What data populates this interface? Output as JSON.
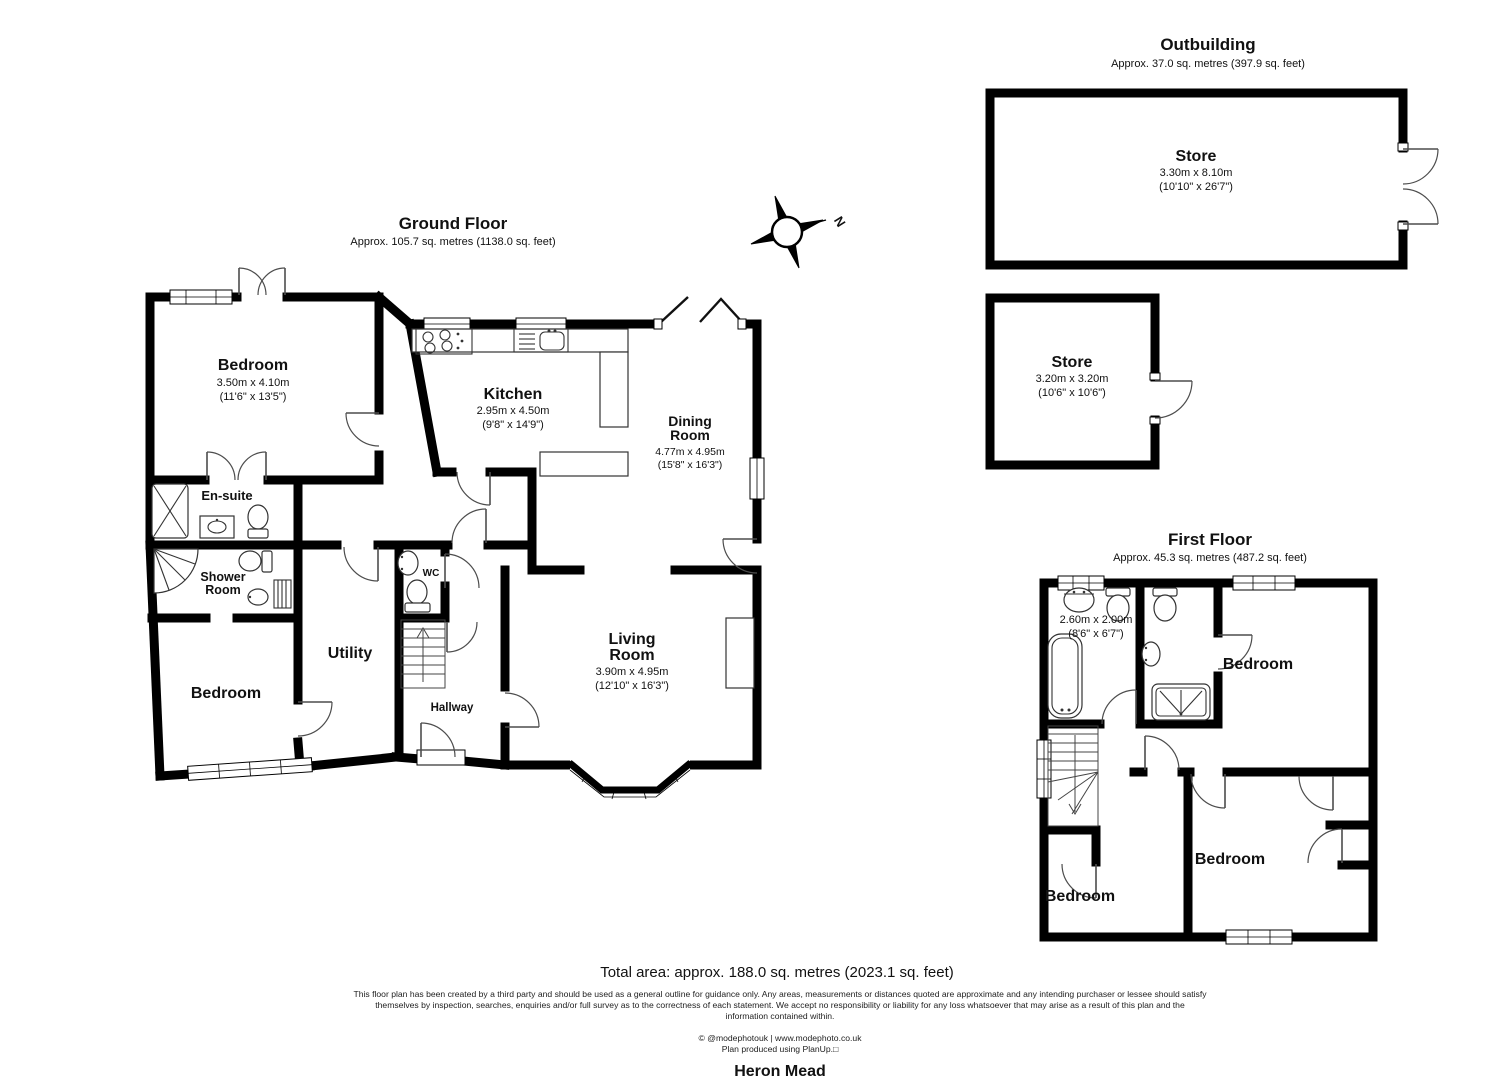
{
  "floors": {
    "ground": {
      "title": "Ground Floor",
      "area": "Approx. 105.7 sq. metres (1138.0 sq. feet)"
    },
    "first": {
      "title": "First Floor",
      "area": "Approx. 45.3 sq. metres (487.2 sq. feet)"
    },
    "outbuilding": {
      "title": "Outbuilding",
      "area": "Approx. 37.0 sq. metres (397.9 sq. feet)"
    }
  },
  "rooms": {
    "gf_bedroom1": {
      "name": "Bedroom",
      "dim_m": "3.50m x 4.10m",
      "dim_ft": "(11'6\" x 13'5\")"
    },
    "gf_kitchen": {
      "name": "Kitchen",
      "dim_m": "2.95m x 4.50m",
      "dim_ft": "(9'8\" x 14'9\")"
    },
    "gf_dining": {
      "name1": "Dining",
      "name2": "Room",
      "dim_m": "4.77m x 4.95m",
      "dim_ft": "(15'8\" x 16'3\")"
    },
    "gf_living": {
      "name1": "Living",
      "name2": "Room",
      "dim_m": "3.90m x 4.95m",
      "dim_ft": "(12'10\" x 16'3\")"
    },
    "gf_ensuite": {
      "name": "En-suite"
    },
    "gf_shower": {
      "name1": "Shower",
      "name2": "Room"
    },
    "gf_bedroom2": {
      "name": "Bedroom"
    },
    "gf_utility": {
      "name": "Utility"
    },
    "gf_wc": {
      "name": "WC"
    },
    "gf_hallway": {
      "name": "Hallway"
    },
    "ff_bath": {
      "dim_m": "2.60m x 2.00m",
      "dim_ft": "(8'6\" x 6'7\")"
    },
    "ff_bedroom1": {
      "name": "Bedroom"
    },
    "ff_bedroom2": {
      "name": "Bedroom"
    },
    "ff_bedroom3": {
      "name": "Bedroom"
    },
    "ob_store1": {
      "name": "Store",
      "dim_m": "3.30m x 8.10m",
      "dim_ft": "(10'10\" x 26'7\")"
    },
    "ob_store2": {
      "name": "Store",
      "dim_m": "3.20m x 3.20m",
      "dim_ft": "(10'6\" x 10'6\")"
    }
  },
  "compass": {
    "north_label": "N"
  },
  "footer": {
    "total_area": "Total area: approx. 188.0 sq. metres (2023.1 sq. feet)",
    "disclaimer_line1": "This floor plan has been created by a third party and should be used as a general outline for guidance only. Any areas, measurements or distances quoted are approximate and any intending purchaser or lessee should satisfy",
    "disclaimer_line2": "themselves by inspection, searches, enquiries and/or full survey as to the correctness of each statement. We accept no responsibility or liability for any loss whatsoever that may arise as a result of this plan and the",
    "disclaimer_line3": "information contained within.",
    "credit": "© @modephotouk | www.modephoto.co.uk",
    "produced": "Plan produced using PlanUp.□",
    "property_name": "Heron Mead"
  },
  "colors": {
    "wall": "#000000",
    "background": "#ffffff"
  }
}
